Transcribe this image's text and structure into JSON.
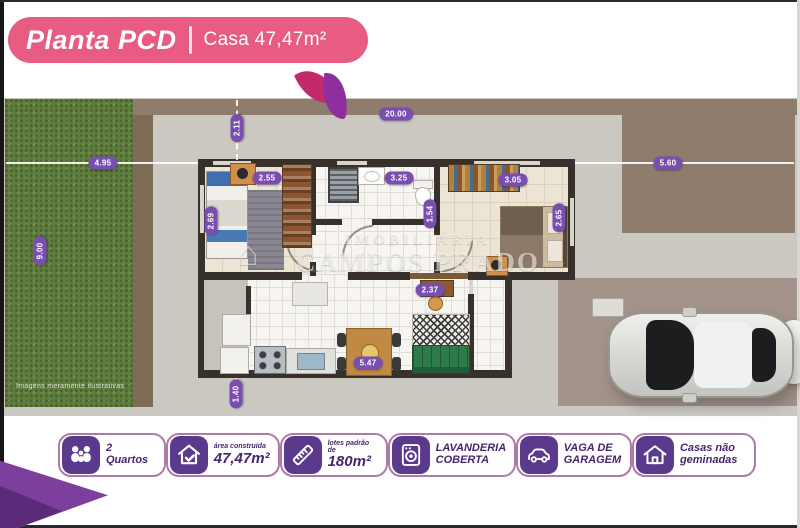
{
  "header": {
    "title": "Planta PCD",
    "separator": "|",
    "subtitle": "Casa 47,47m²"
  },
  "watermark": {
    "line1": "IMOBILIÁRIA",
    "line2": "CAMPOS PRADO"
  },
  "disclaimer": "Imagens meramente ilustrativas",
  "dims": {
    "lot_width": "20.00",
    "front_setback": "2.11",
    "left_yard": "4.95",
    "right_yard": "5.60",
    "yard_depth": "9.00",
    "bedroom1_width": "2.55",
    "bedroom1_depth": "2.69",
    "bathroom_width": "3.25",
    "bathroom_depth": "1.54",
    "bedroom2_width": "3.05",
    "bedroom2_depth": "2.65",
    "hall_width": "2.37",
    "living_width": "5.47",
    "laundry_width": "1.40"
  },
  "badges": [
    {
      "icon": "family-icon",
      "label": "2 Quartos"
    },
    {
      "icon": "house-check-icon",
      "small": "área construída",
      "big": "47,47m²"
    },
    {
      "icon": "ruler-icon",
      "small": "lotes padrão de",
      "big": "180m²"
    },
    {
      "icon": "washing-machine-icon",
      "label": "LAVANDERIA COBERTA"
    },
    {
      "icon": "car-icon",
      "label": "VAGA DE GARAGEM"
    },
    {
      "icon": "double-house-icon",
      "label": "Casas não geminadas"
    }
  ],
  "colors": {
    "banner_pink": "#e75c80",
    "badge_purple": "#5b3a8e",
    "pill_purple": "#7a4eb0",
    "grass_green": "#5f7d3e",
    "sofa_green": "#2d7a4b"
  }
}
